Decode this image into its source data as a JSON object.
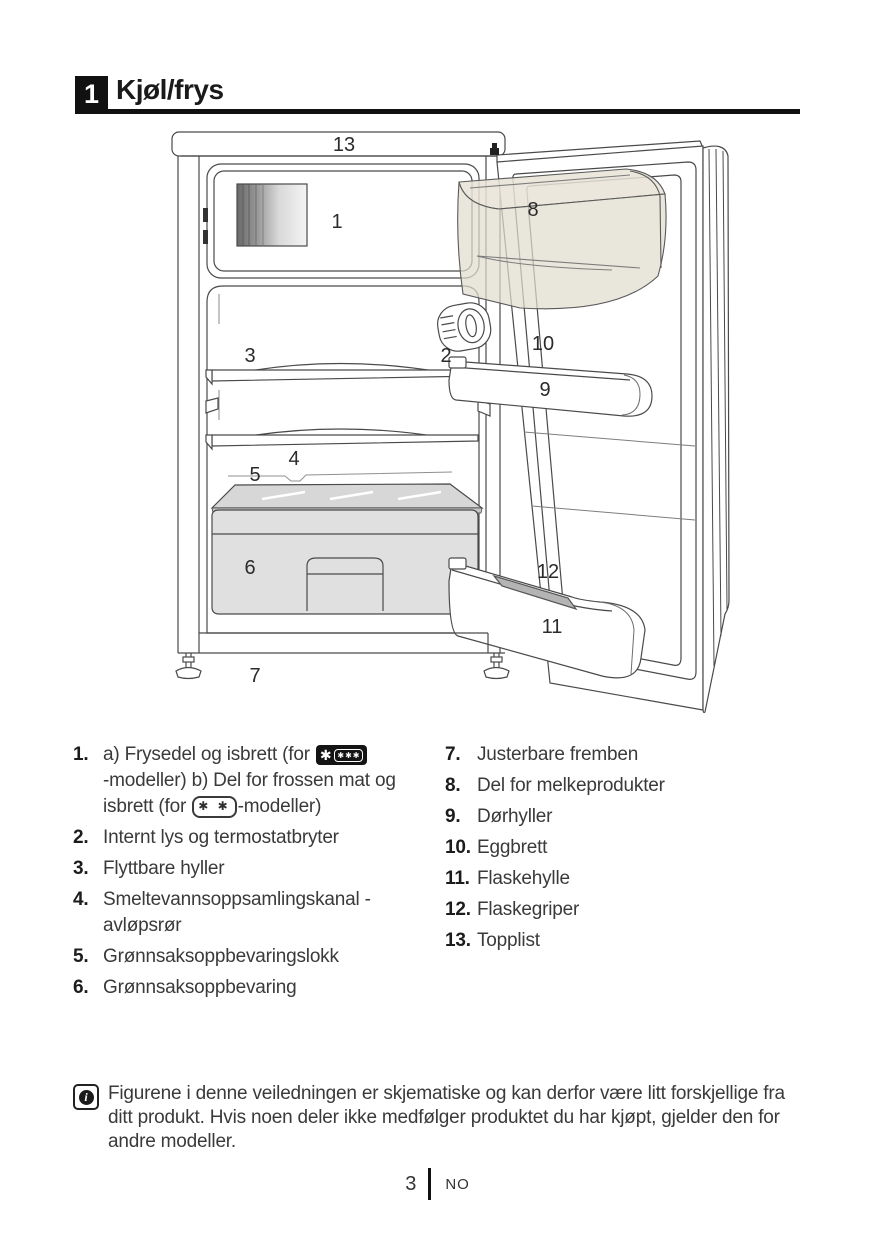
{
  "header": {
    "chapter_number": "1",
    "title": "Kjøl/frys"
  },
  "diagram": {
    "labels": {
      "n1": "1",
      "n2": "2",
      "n3": "3",
      "n4": "4",
      "n5": "5",
      "n6": "6",
      "n7": "7",
      "n8": "8",
      "n9": "9",
      "n10": "10",
      "n11": "11",
      "n12": "12",
      "n13": "13"
    }
  },
  "parts_list": {
    "item1": {
      "num": "1.",
      "line1_text": "a) Frysedel og isbrett (for",
      "badge_4star": {
        "big_star": "✱",
        "small_stars": "✱✱✱"
      },
      "line2_text": "-modeller)  b) Del for frossen mat og",
      "line3_pre": "isbrett (for",
      "badge_2star": {
        "stars": "✱ ✱"
      },
      "line3_post": "-modeller)"
    },
    "left": [
      {
        "num": "2.",
        "text": "Internt lys og termostatbryter"
      },
      {
        "num": "3.",
        "text": "Flyttbare hyller"
      },
      {
        "num": "4.",
        "text": "Smeltevannsoppsamlingskanal - avløpsrør"
      },
      {
        "num": "5.",
        "text": "Grønnsaksoppbevaringslokk"
      },
      {
        "num": "6.",
        "text": "Grønnsaksoppbevaring"
      }
    ],
    "right": [
      {
        "num": "7.",
        "text": "Justerbare fremben"
      },
      {
        "num": "8.",
        "text": "Del for melkeprodukter"
      },
      {
        "num": "9.",
        "text": "Dørhyller"
      },
      {
        "num": "10.",
        "text": "Eggbrett"
      },
      {
        "num": "11.",
        "text": "Flaskehylle"
      },
      {
        "num": "12.",
        "text": "Flaskegriper"
      },
      {
        "num": "13.",
        "text": "Topplist"
      }
    ]
  },
  "note": {
    "icon_letter": "i",
    "text": "Figurene i denne veiledningen er skjematiske og kan derfor være litt forskjellige fra ditt produkt. Hvis noen deler ikke medfølger produktet du har kjøpt, gjelder den for andre modeller."
  },
  "footer": {
    "page_number": "3",
    "language": "NO"
  }
}
